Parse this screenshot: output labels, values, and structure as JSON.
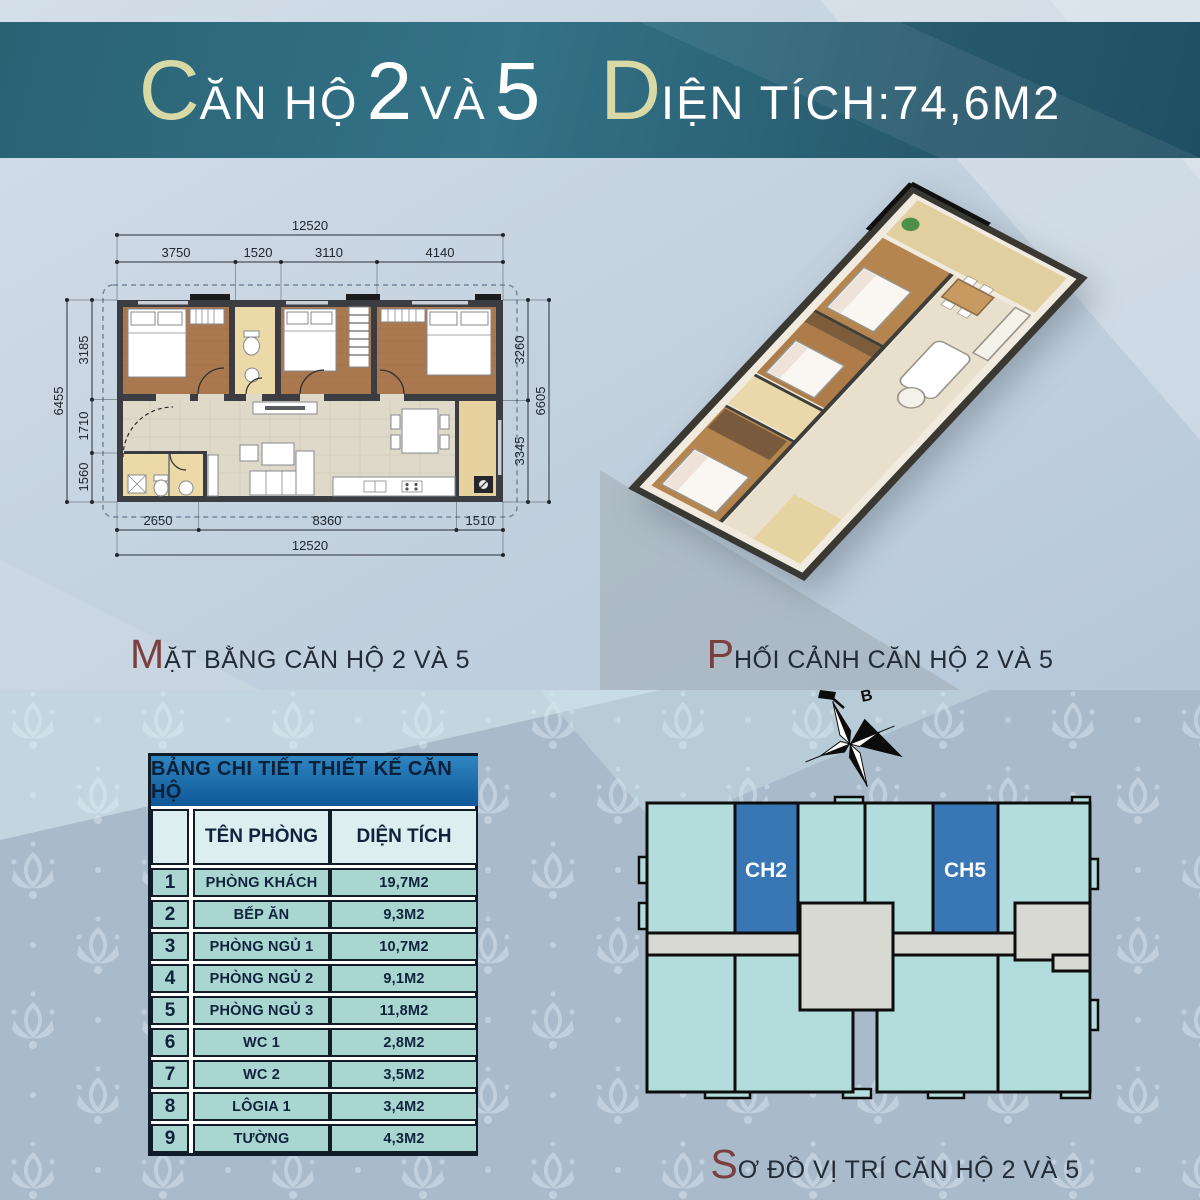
{
  "banner": {
    "left": {
      "initial": "C",
      "text": "ĂN HỘ",
      "num1": "2",
      "conj": "VÀ",
      "num2": "5"
    },
    "right": {
      "initial": "D",
      "text": "IỆN TÍCH:",
      "value": "74,6M2"
    }
  },
  "captions": {
    "plan": {
      "initial": "M",
      "rest": "ẶT BẰNG CĂN HỘ 2 VÀ 5"
    },
    "view": {
      "initial": "P",
      "rest": "HỐI CẢNH CĂN HỘ 2 VÀ 5"
    },
    "location": {
      "initial": "S",
      "rest": "Ơ ĐỒ VỊ TRÍ CĂN HỘ 2 VÀ 5"
    }
  },
  "table": {
    "title": "BẢNG CHI TIẾT THIẾT KẾ CĂN HỘ",
    "columns": [
      "TÊN PHÒNG",
      "DIỆN TÍCH"
    ],
    "rows": [
      {
        "no": "1",
        "name": "PHÒNG KHÁCH",
        "area": "19,7M2"
      },
      {
        "no": "2",
        "name": "BẾP ĂN",
        "area": "9,3M2"
      },
      {
        "no": "3",
        "name": "PHÒNG NGỦ 1",
        "area": "10,7M2"
      },
      {
        "no": "4",
        "name": "PHÒNG NGỦ 2",
        "area": "9,1M2"
      },
      {
        "no": "5",
        "name": "PHÒNG NGỦ 3",
        "area": "11,8M2"
      },
      {
        "no": "6",
        "name": "WC 1",
        "area": "2,8M2"
      },
      {
        "no": "7",
        "name": "WC 2",
        "area": "3,5M2"
      },
      {
        "no": "8",
        "name": "LÔGIA 1",
        "area": "3,4M2"
      },
      {
        "no": "9",
        "name": "TƯỜNG",
        "area": "4,3M2"
      }
    ]
  },
  "floor_plan": {
    "dimensions": {
      "top_total": "12520",
      "top_segments": [
        "3750",
        "1520",
        "3110",
        "4140"
      ],
      "left_total": "6455",
      "left_segments": [
        "3185",
        "1710",
        "1560"
      ],
      "right_total": "6605",
      "right_segments": [
        "3260",
        "3345"
      ],
      "bottom_segments": [
        "2650",
        "8360",
        "1510"
      ],
      "bottom_total": "12520"
    }
  },
  "location_diagram": {
    "units": [
      {
        "id": "CH2"
      },
      {
        "id": "CH5"
      }
    ],
    "compass_label": "B",
    "colors": {
      "unit": "#b3dcdc",
      "highlight": "#3876b6",
      "core": "#d9d9d4"
    }
  },
  "colors": {
    "banner_bg": "#2b6e82",
    "banner_initial": "#d9d9a6",
    "caption_initial": "#7b3f3f",
    "text_dark": "#10233c",
    "table_header_bg": "#1c74b4",
    "table_colheader_bg": "#dceef0",
    "table_row_bg": "#a9d6d0"
  }
}
